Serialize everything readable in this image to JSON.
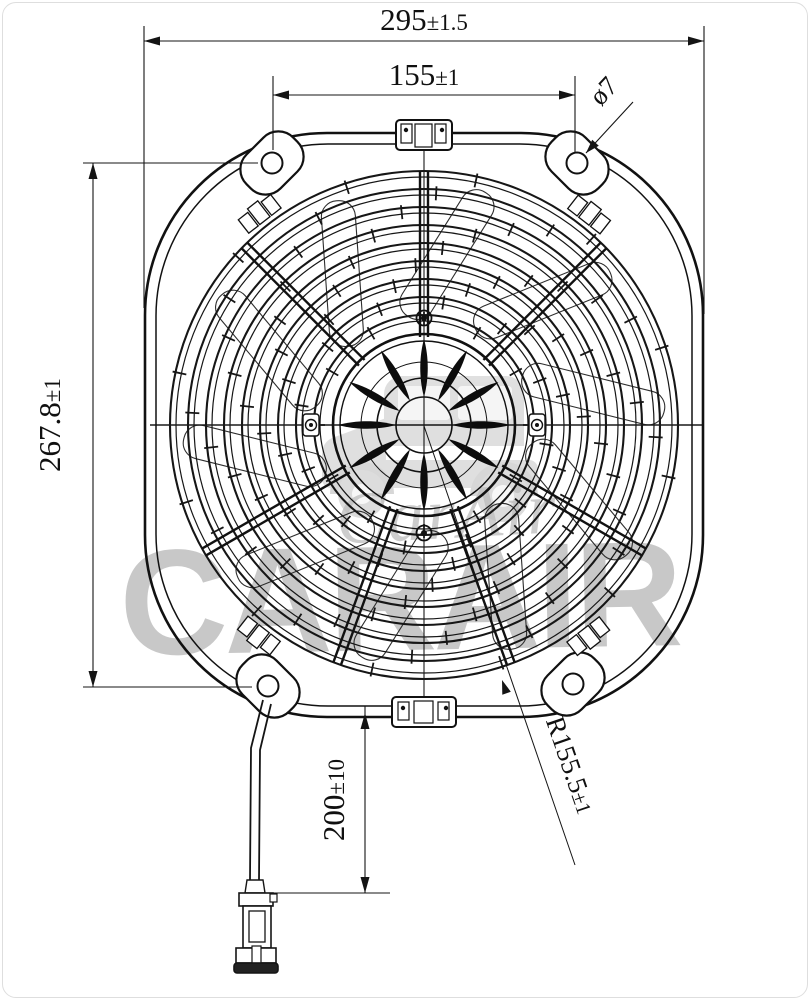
{
  "drawing": {
    "type": "technical drawing",
    "subject": "axial cooling fan, front view, with lead wire and connector",
    "dims": {
      "overall_width": {
        "value": "295",
        "tol": "±1.5"
      },
      "hole_pitch_x": {
        "value": "155",
        "tol": "±1"
      },
      "hole_dia": {
        "value": "ø7",
        "tol": ""
      },
      "hole_pitch_y": {
        "value": "267.8",
        "tol": "±1"
      },
      "lead_length": {
        "value": "200",
        "tol": "±10"
      },
      "fan_radius": {
        "value": "R155.5",
        "tol": "±1"
      }
    },
    "watermark": {
      "script": "CarAir",
      "block": "CARAIR"
    },
    "colors": {
      "line": "#141414",
      "watermark": "#c3c3c3",
      "background": "#ffffff"
    }
  }
}
